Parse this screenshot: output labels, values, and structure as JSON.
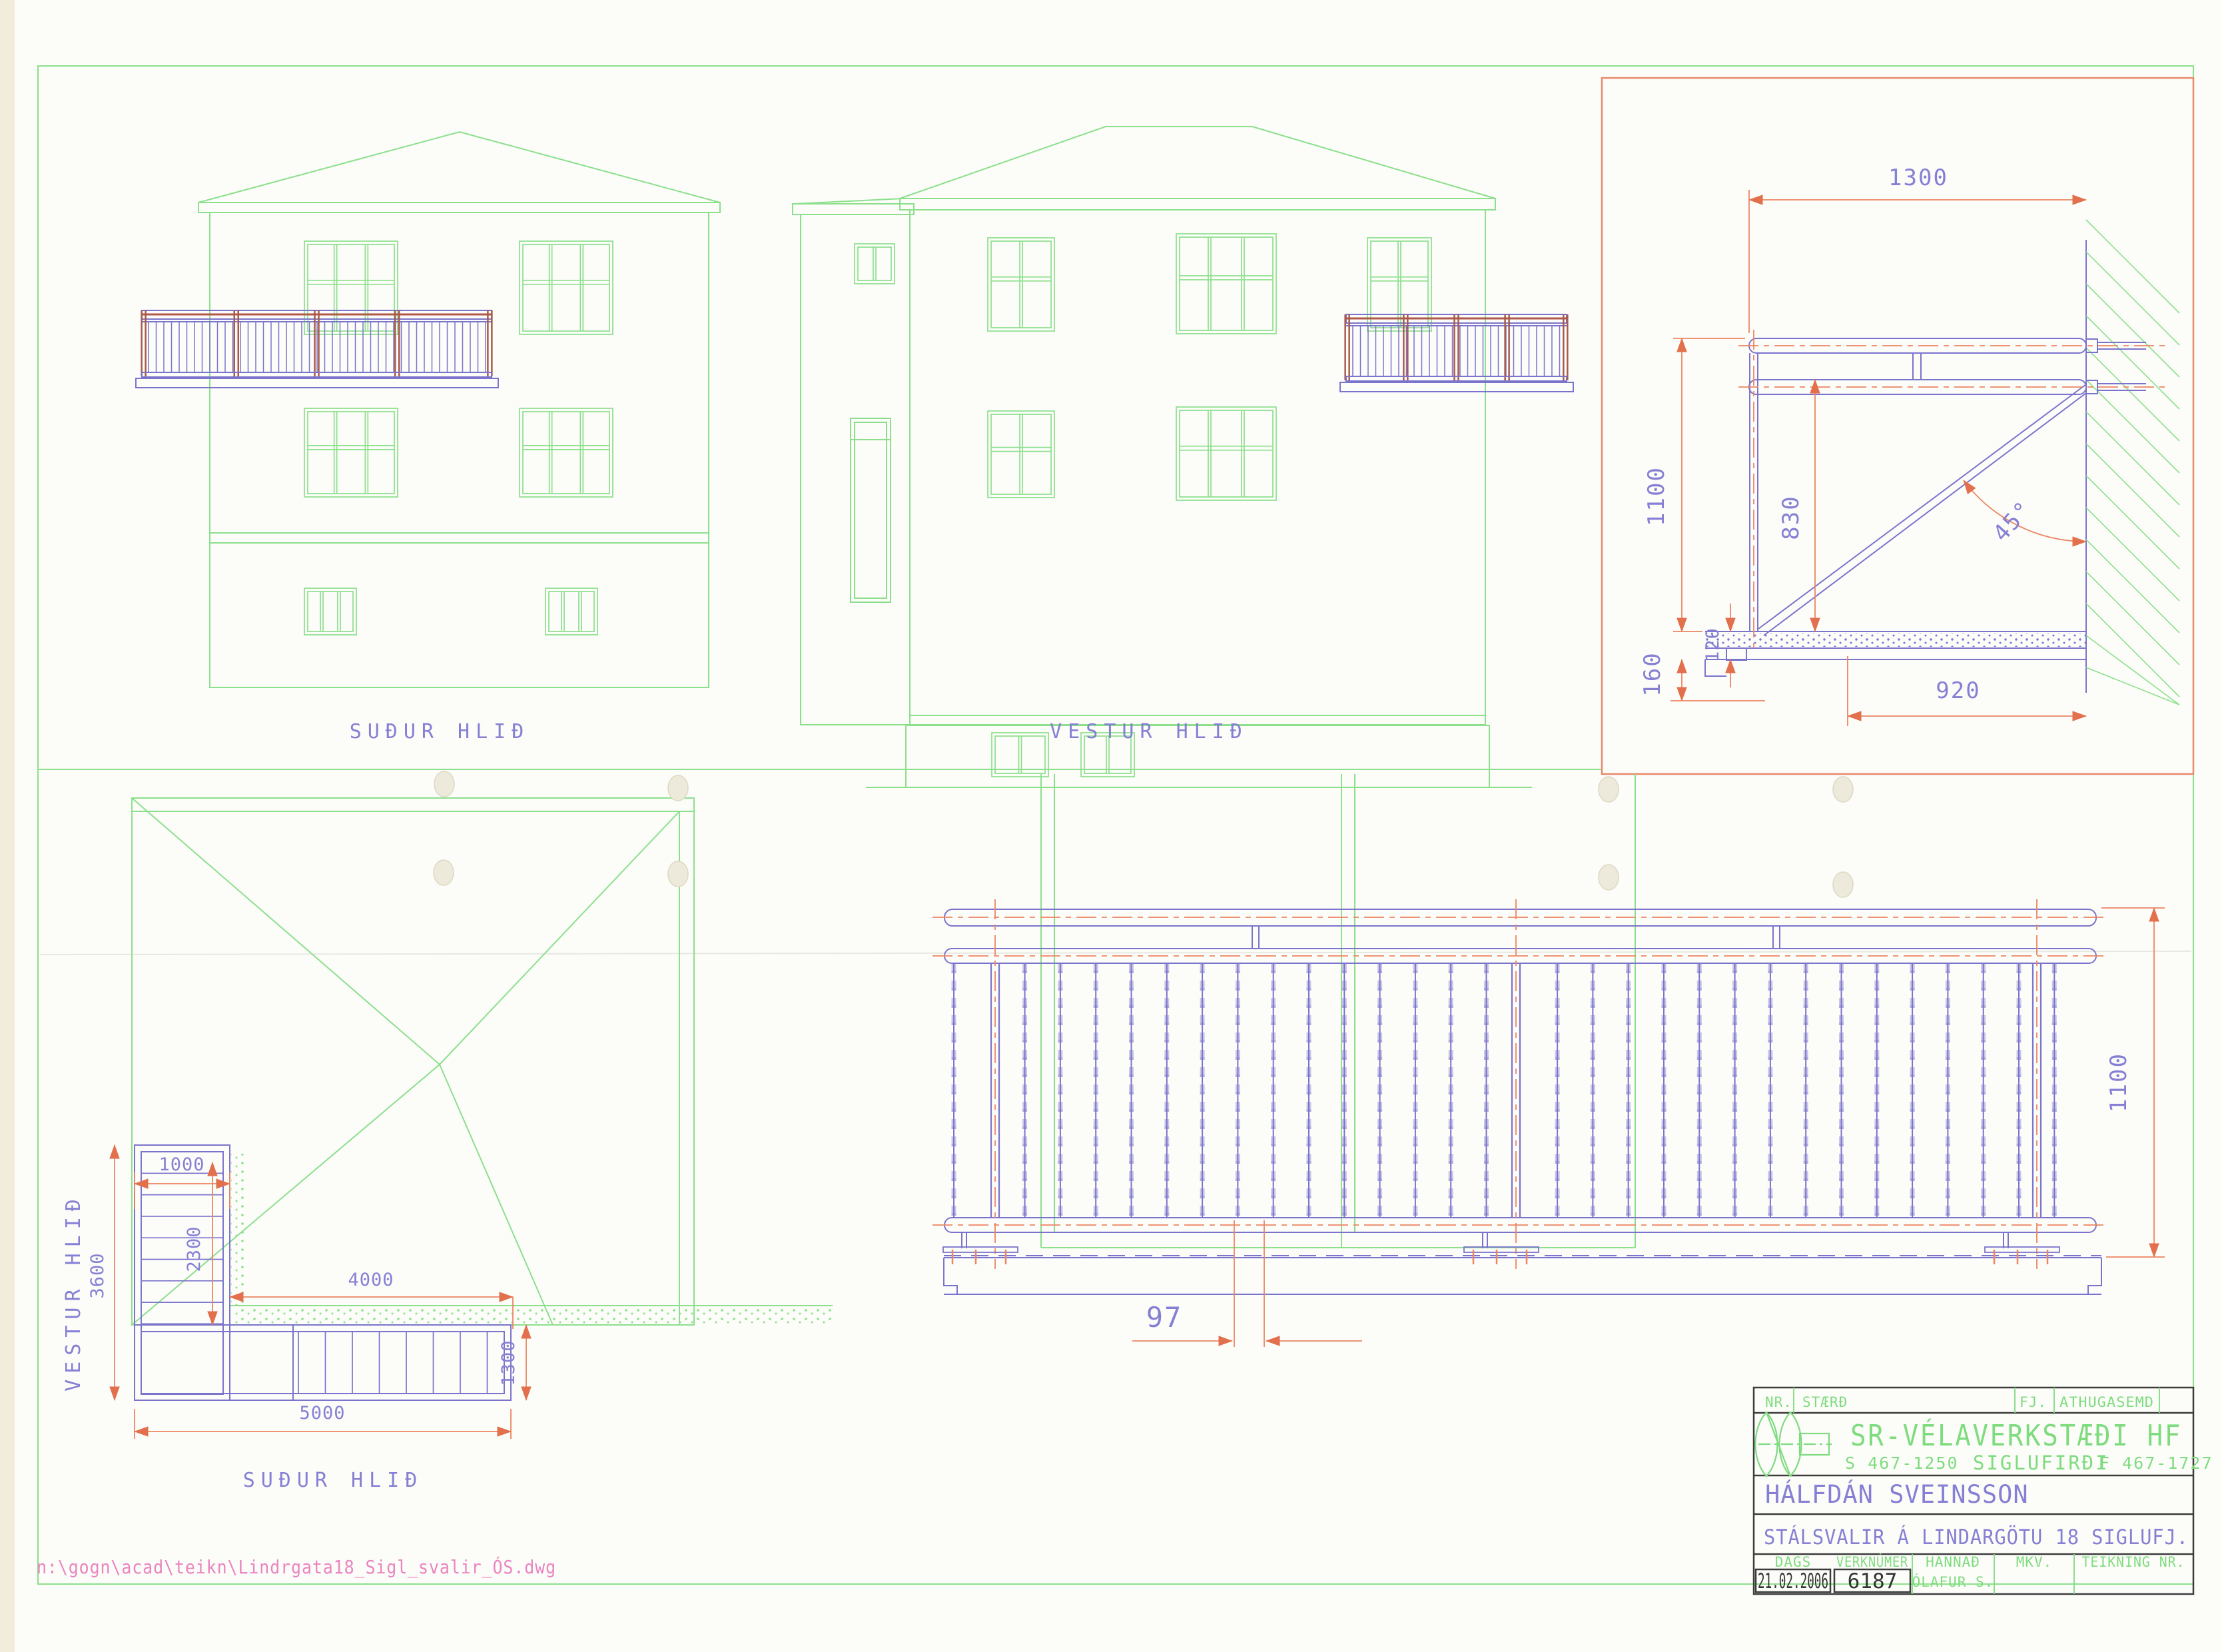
{
  "colors": {
    "drawing_green": "#8ce08c",
    "railing_violet": "#7b74cc",
    "dimension_orange": "#ec8562",
    "text_violet": "#8680d4",
    "title_green": "#7edc7e",
    "path_pink": "#ea85c0"
  },
  "elevations": {
    "south": {
      "label": "SUÐUR HLIÐ"
    },
    "west": {
      "label": "VESTUR HLIÐ"
    }
  },
  "plan": {
    "west_label": "VESTUR HLIÐ",
    "south_label": "SUÐUR HLIÐ",
    "dims": {
      "top": "1000",
      "left": "3600",
      "inner_left": "2300",
      "wall": "4000",
      "right": "1300",
      "bottom": "5000"
    }
  },
  "detail": {
    "dims": {
      "width": "1300",
      "height": "1100",
      "rail": "830",
      "angle": "45°",
      "deck": "120",
      "edge": "160",
      "bracket": "920"
    }
  },
  "railing": {
    "dims": {
      "height": "1100",
      "spacing": "97"
    }
  },
  "title_block": {
    "header": {
      "nr": "NR.",
      "size": "STÆRÐ",
      "qty": "FJ.",
      "note": "ATHUGASEMD"
    },
    "company": {
      "name": "SR-VÉLAVERKSTÆÐI HF",
      "phone": "S 467-1250",
      "city": "SIGLUFIRÐI",
      "fax": "F 467-1727"
    },
    "client": "HÁLFDÁN SVEINSSON",
    "project": "STÁLSVALIR Á LINDARGÖTU 18 SIGLUFJ.",
    "footer": {
      "date_label": "DAGS",
      "date": "21.02.2006",
      "job_label": "VERKNÚMER",
      "job": "6187",
      "designed_label": "HANNAÐ",
      "designed": "ÓLAFUR S.",
      "scale_label": "MKV.",
      "drawing_no_label": "TEIKNING NR."
    }
  },
  "file_path": "n:\\gogn\\acad\\teikn\\Lindrgata18_Sigl_svalir_ÓS.dwg"
}
